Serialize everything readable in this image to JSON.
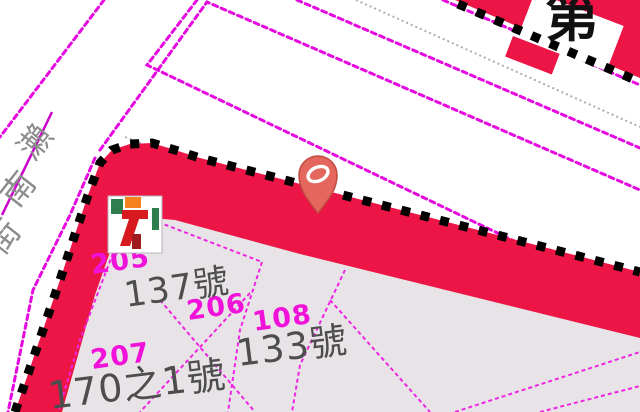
{
  "map": {
    "district_label": "第",
    "road_name": {
      "full": "瀨南街",
      "chars": [
        "瀨",
        "南",
        "街"
      ]
    },
    "parcel_numbers": {
      "p205": "205",
      "p206": "206",
      "p207": "207",
      "p108": "108"
    },
    "addresses": {
      "a137": "137號",
      "a133": "133號",
      "a170": "170之1號"
    },
    "poi": {
      "name": "seven-eleven",
      "digit": "7"
    },
    "marker": {
      "name": "location-pin"
    },
    "colors": {
      "road_line_magenta": "#E509DF",
      "parcel_line_magenta": "#EF25E3",
      "boundary_band_red": "#EC1545",
      "boundary_dash_black": "#000000",
      "parcel_fill_gray": "#E7E3E6",
      "address_text_gray": "#4D4D4D",
      "parcel_text_magenta": "#F012D8",
      "road_name_gray": "#8C8C8C",
      "pin_fill": "#E4675D",
      "gray_dotted_line": "#ADADAD"
    }
  }
}
